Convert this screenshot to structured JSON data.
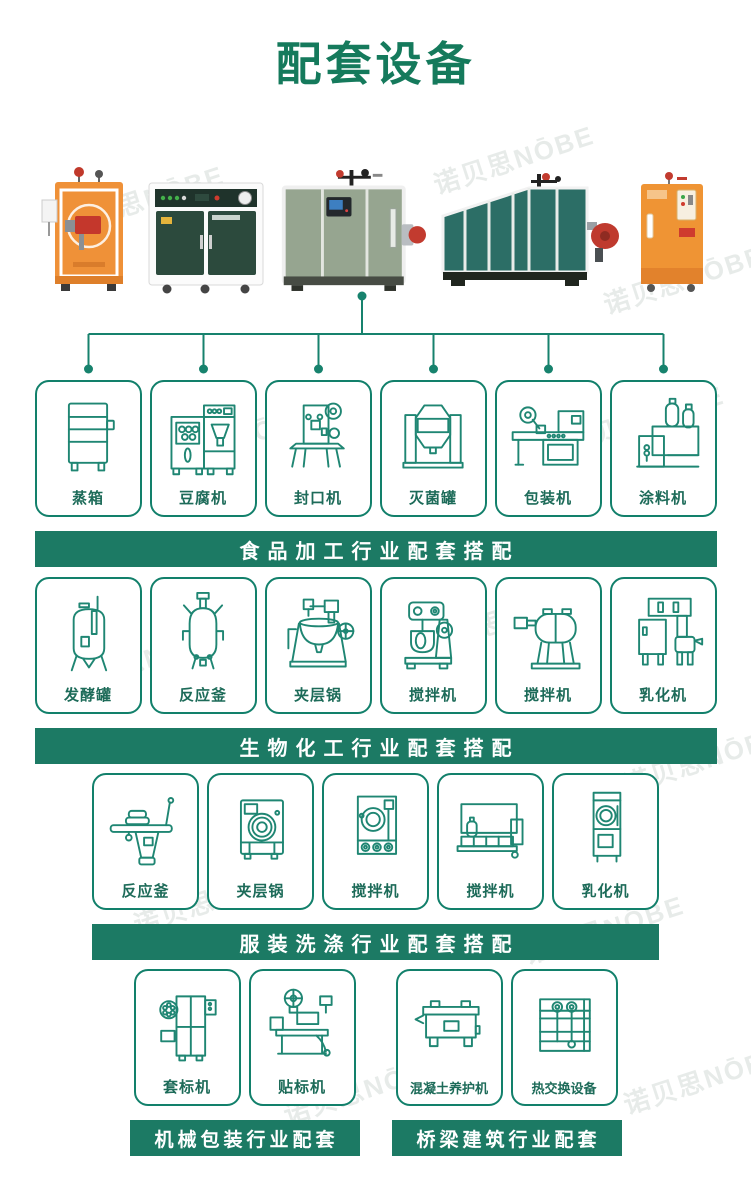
{
  "page": {
    "title": "配套设备",
    "watermark": "诺贝思NŌBE"
  },
  "colors": {
    "title": "#157a5c",
    "accent": "#17826d",
    "banner_bg": "#1c7a64",
    "banner_text": "#ffffff",
    "card_border": "#12806b",
    "card_label": "#1d6b59",
    "icon_stroke": "#1f8673"
  },
  "products": [
    {
      "name": "product-photo-orange-vertical-steam-generator"
    },
    {
      "name": "product-photo-green-cabinet-steam-boiler"
    },
    {
      "name": "product-photo-sage-cube-steam-boiler"
    },
    {
      "name": "product-photo-teal-horizontal-steam-boiler"
    },
    {
      "name": "product-photo-orange-cabinet-steam-generator"
    }
  ],
  "sections": [
    {
      "id": "food-processing",
      "banner": "食品加工行业配套搭配",
      "items": [
        {
          "label": "蒸箱",
          "icon": "steam-cabinet-icon"
        },
        {
          "label": "豆腐机",
          "icon": "tofu-machine-icon"
        },
        {
          "label": "封口机",
          "icon": "sealing-machine-icon"
        },
        {
          "label": "灭菌罐",
          "icon": "sterilizer-tank-icon"
        },
        {
          "label": "包装机",
          "icon": "packing-machine-icon"
        },
        {
          "label": "涂料机",
          "icon": "coating-machine-icon"
        }
      ]
    },
    {
      "id": "biochemical",
      "banner": "生物化工行业配套搭配",
      "items": [
        {
          "label": "发酵罐",
          "icon": "fermentation-tank-icon"
        },
        {
          "label": "反应釜",
          "icon": "reaction-kettle-icon"
        },
        {
          "label": "夹层锅",
          "icon": "jacketed-kettle-icon"
        },
        {
          "label": "搅拌机",
          "icon": "planetary-mixer-icon"
        },
        {
          "label": "搅拌机",
          "icon": "drum-mixer-icon"
        },
        {
          "label": "乳化机",
          "icon": "emulsifier-icon"
        }
      ]
    },
    {
      "id": "laundry",
      "banner": "服装洗涤行业配套搭配",
      "items": [
        {
          "label": "反应釜",
          "icon": "ironing-table-icon"
        },
        {
          "label": "夹层锅",
          "icon": "washing-machine-icon"
        },
        {
          "label": "搅拌机",
          "icon": "dryer-machine-icon"
        },
        {
          "label": "搅拌机",
          "icon": "flatwork-ironer-icon"
        },
        {
          "label": "乳化机",
          "icon": "tall-dryer-icon"
        }
      ]
    }
  ],
  "bottom_groups": [
    {
      "id": "machinery-packing",
      "banner": "机械包装行业配套",
      "items": [
        {
          "label": "套标机",
          "icon": "sleeve-labeler-icon"
        },
        {
          "label": "贴标机",
          "icon": "labeling-machine-icon"
        }
      ]
    },
    {
      "id": "bridge-construction",
      "banner": "桥梁建筑行业配套",
      "items": [
        {
          "label": "混凝土养护机",
          "icon": "concrete-curing-machine-icon"
        },
        {
          "label": "热交换设备",
          "icon": "heat-exchanger-icon"
        }
      ]
    }
  ]
}
